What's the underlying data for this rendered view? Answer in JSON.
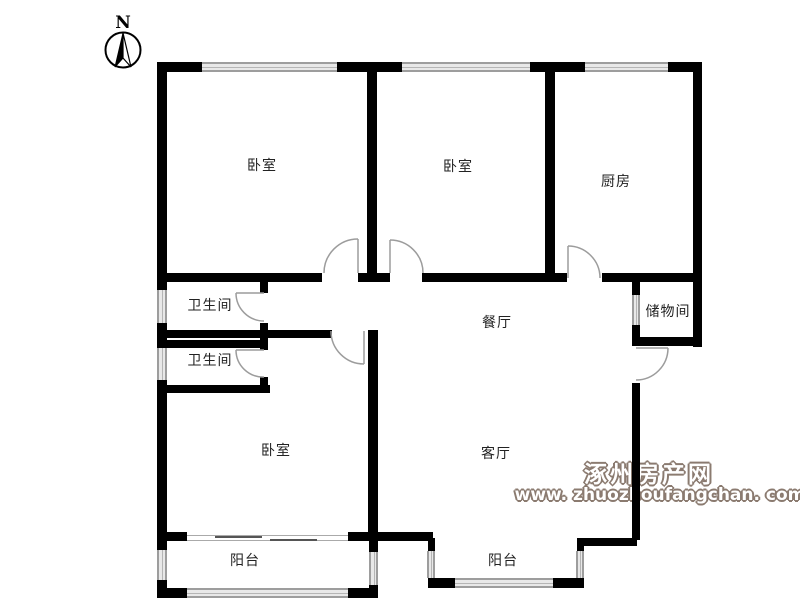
{
  "compass": {
    "north_label": "N"
  },
  "rooms": {
    "bedroom1": "卧室",
    "bedroom2": "卧室",
    "bedroom3": "卧室",
    "kitchen": "厨房",
    "bathroom1": "卫生间",
    "bathroom2": "卫生间",
    "dining": "餐厅",
    "living": "客厅",
    "storage": "储物间",
    "balcony1": "阳台",
    "balcony2": "阳台"
  },
  "watermark": {
    "line1": "涿州房产网",
    "line2": "www. zhuozhoufangchan. com"
  },
  "colors": {
    "wall": "#000000",
    "window_line": "#9d9d9d",
    "door_line": "#9c9c9c",
    "watermark_outline": "#8b7b70",
    "label_text": "#222222",
    "background": "#ffffff"
  }
}
